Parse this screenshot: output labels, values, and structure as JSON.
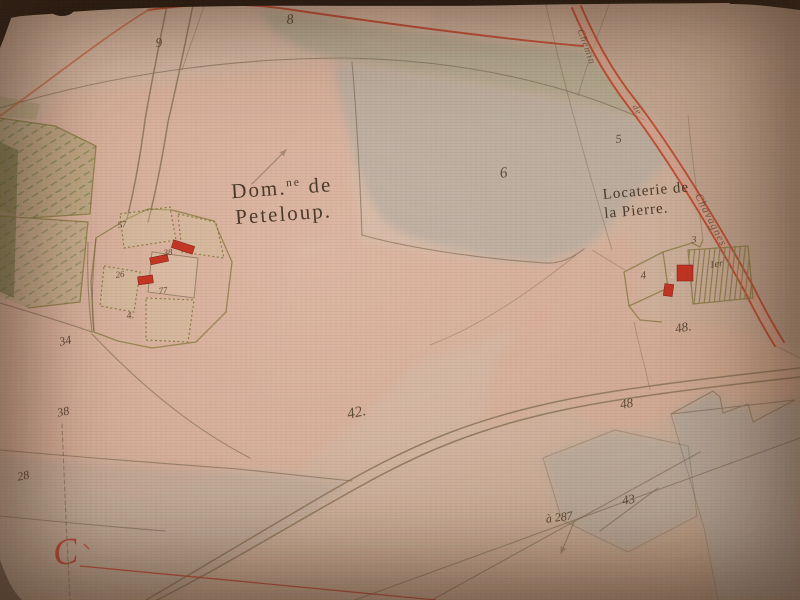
{
  "colors": {
    "paper": "#d3b6a2",
    "ink": "#43321f",
    "pencil": "#6f5c45",
    "road_red": "#c0452e",
    "road_orange": "#c56a48",
    "building_red": "#c53524",
    "wash_pink": "#e0a48e",
    "wash_gray": "#a7a49b",
    "wash_green8": "#9aa083",
    "hatch_green": "#6b7a3d",
    "edge_dark": "#241a11",
    "label_red": "#b8402e"
  },
  "place_labels": {
    "domaine": {
      "prefix": "Dom.",
      "sup": "ne",
      "rest": " de",
      "line2": "Peteloup."
    },
    "locaterie": {
      "line1": "Locaterie de",
      "line2": "la Pierre."
    },
    "corner_letter": "C"
  },
  "road_labels": [
    {
      "text": "Chemin",
      "x": 584,
      "y": 28,
      "size": 10,
      "rot": 70
    },
    {
      "text": "de",
      "x": 638,
      "y": 103,
      "size": 9,
      "rot": 58
    },
    {
      "text": "Chavagnes",
      "x": 702,
      "y": 192,
      "size": 11,
      "rot": 63
    }
  ],
  "parcel_numbers": [
    {
      "text": "8",
      "x": 286,
      "y": 14,
      "size": 14,
      "rot": -6
    },
    {
      "text": "9",
      "x": 155,
      "y": 36,
      "size": 13,
      "rot": -6
    },
    {
      "text": "6",
      "x": 499,
      "y": 167,
      "size": 15,
      "rot": -8
    },
    {
      "text": "5",
      "x": 615,
      "y": 133,
      "size": 12,
      "rot": -6
    },
    {
      "text": "3",
      "x": 691,
      "y": 236,
      "size": 10,
      "rot": -6
    },
    {
      "text": "4",
      "x": 640,
      "y": 271,
      "size": 11,
      "rot": -6
    },
    {
      "text": "2",
      "x": 670,
      "y": 272,
      "size": 8,
      "rot": 0,
      "color": "#e8d5c0"
    },
    {
      "text": "1er",
      "x": 709,
      "y": 261,
      "size": 10,
      "rot": -8
    },
    {
      "text": "48.",
      "x": 674,
      "y": 322,
      "size": 13,
      "rot": -10
    },
    {
      "text": "48",
      "x": 619,
      "y": 398,
      "size": 13,
      "rot": -10
    },
    {
      "text": "42.",
      "x": 346,
      "y": 408,
      "size": 15,
      "rot": -12
    },
    {
      "text": "43",
      "x": 621,
      "y": 494,
      "size": 13,
      "rot": -10
    },
    {
      "text": "à 287",
      "x": 545,
      "y": 513,
      "size": 12,
      "rot": -8
    },
    {
      "text": "34",
      "x": 58,
      "y": 336,
      "size": 12,
      "rot": -12
    },
    {
      "text": "38",
      "x": 56,
      "y": 407,
      "size": 12,
      "rot": -12
    },
    {
      "text": "28",
      "x": 16,
      "y": 471,
      "size": 12,
      "rot": -12
    },
    {
      "text": "57",
      "x": 117,
      "y": 221,
      "size": 9,
      "rot": -8
    },
    {
      "text": "38",
      "x": 163,
      "y": 249,
      "size": 9,
      "rot": -8
    },
    {
      "text": "26",
      "x": 115,
      "y": 271,
      "size": 9,
      "rot": -8
    },
    {
      "text": "77",
      "x": 158,
      "y": 287,
      "size": 9,
      "rot": -8
    },
    {
      "text": "4.",
      "x": 126,
      "y": 312,
      "size": 10,
      "rot": -8
    }
  ]
}
